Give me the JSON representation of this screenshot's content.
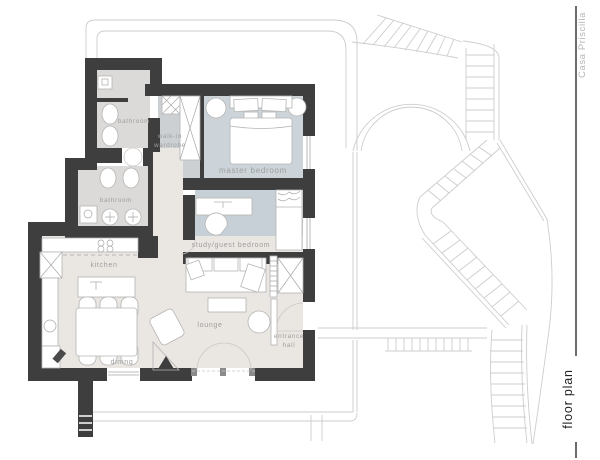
{
  "title": {
    "project": "Casa Priscilla",
    "sheet": "floor plan"
  },
  "rooms": {
    "bathroom_top": "bathroom",
    "bathroom_mid": "bathroom",
    "walk_in_line1": "walk-in",
    "walk_in_line2": "wardrobe",
    "master": "master bedroom",
    "study": "study/guest bedroom",
    "kitchen": "kitchen",
    "dining": "dining",
    "lounge": "lounge",
    "entrance_line1": "entrance",
    "entrance_line2": "hall"
  },
  "colors": {
    "wall": "#3e3e3e",
    "floor_living": "#eae6e2",
    "floor_bathroom": "#dcdad8",
    "floor_master": "#ccd4d9",
    "floor_study": "#c7d0d6",
    "floor_wardrobe": "#cdd0d3",
    "outdoor_line": "#cdcdcd",
    "label_text": "#9e9e9e",
    "title_muted": "#b5b5b5",
    "title_dark": "#222222"
  }
}
